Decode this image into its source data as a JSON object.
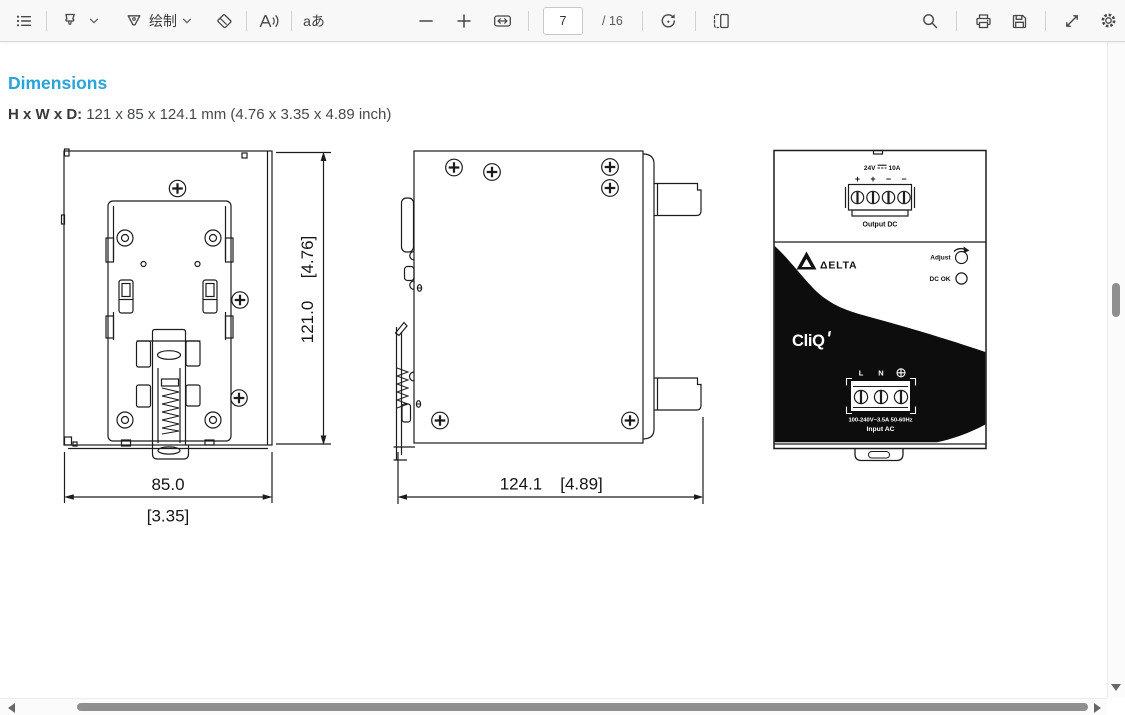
{
  "toolbar": {
    "draw_label": "绘制",
    "page_current": "7",
    "page_total": "/ 16",
    "translate_label": "aあ",
    "read_aloud_letter": "A"
  },
  "page": {
    "heading": "Dimensions",
    "size_label": "H x W x D:",
    "size_value": "121 x 85 x 124.1 mm (4.76 x 3.35 x 4.89 inch)"
  },
  "drawings": {
    "back_view": {
      "width_mm": "85.0",
      "width_in": "[3.35]",
      "height_mm": "121.0",
      "height_in": "[4.76]"
    },
    "side_view": {
      "depth_mm": "124.1",
      "depth_in": "[4.89]"
    },
    "front_view": {
      "output_voltage": "24V",
      "output_current": "10A",
      "polarity": [
        "+",
        "+",
        "−",
        "−"
      ],
      "output_label": "Output DC",
      "brand": "ΔELTA",
      "adjust_label": "Adjust",
      "dc_ok_label": "DC OK",
      "logo": "CliQ",
      "input_line": "L",
      "input_neutral": "N",
      "input_rating": "100-240V~3.5A 50-60Hz",
      "input_label": "Input AC"
    }
  },
  "icons": {
    "outline": "≡",
    "highlighter": "marker-nib",
    "draw-pen": "▽",
    "eraser": "◇",
    "read-aloud": "A))",
    "translate": "aあ",
    "zoom-out": "−",
    "zoom-in": "+",
    "fit-width": "↔ in box",
    "rotate": "circular-arrow",
    "page-view": "two-pages",
    "search": "magnifier",
    "print": "printer",
    "save": "floppy-disk",
    "fullscreen": "diagonal-arrows",
    "settings": "gear",
    "scroll-up": "▲",
    "scroll-down": "▼",
    "scroll-left": "◀",
    "scroll-right": "▶",
    "dc-symbol": "⎓",
    "ground": "⊕"
  },
  "colors": {
    "accent_blue": "#29a4d9",
    "ink": "#1c1c1c",
    "toolbar_icon": "#474747",
    "scroll_thumb": "#8f8f8f",
    "panel_black": "#0d0d0d"
  }
}
